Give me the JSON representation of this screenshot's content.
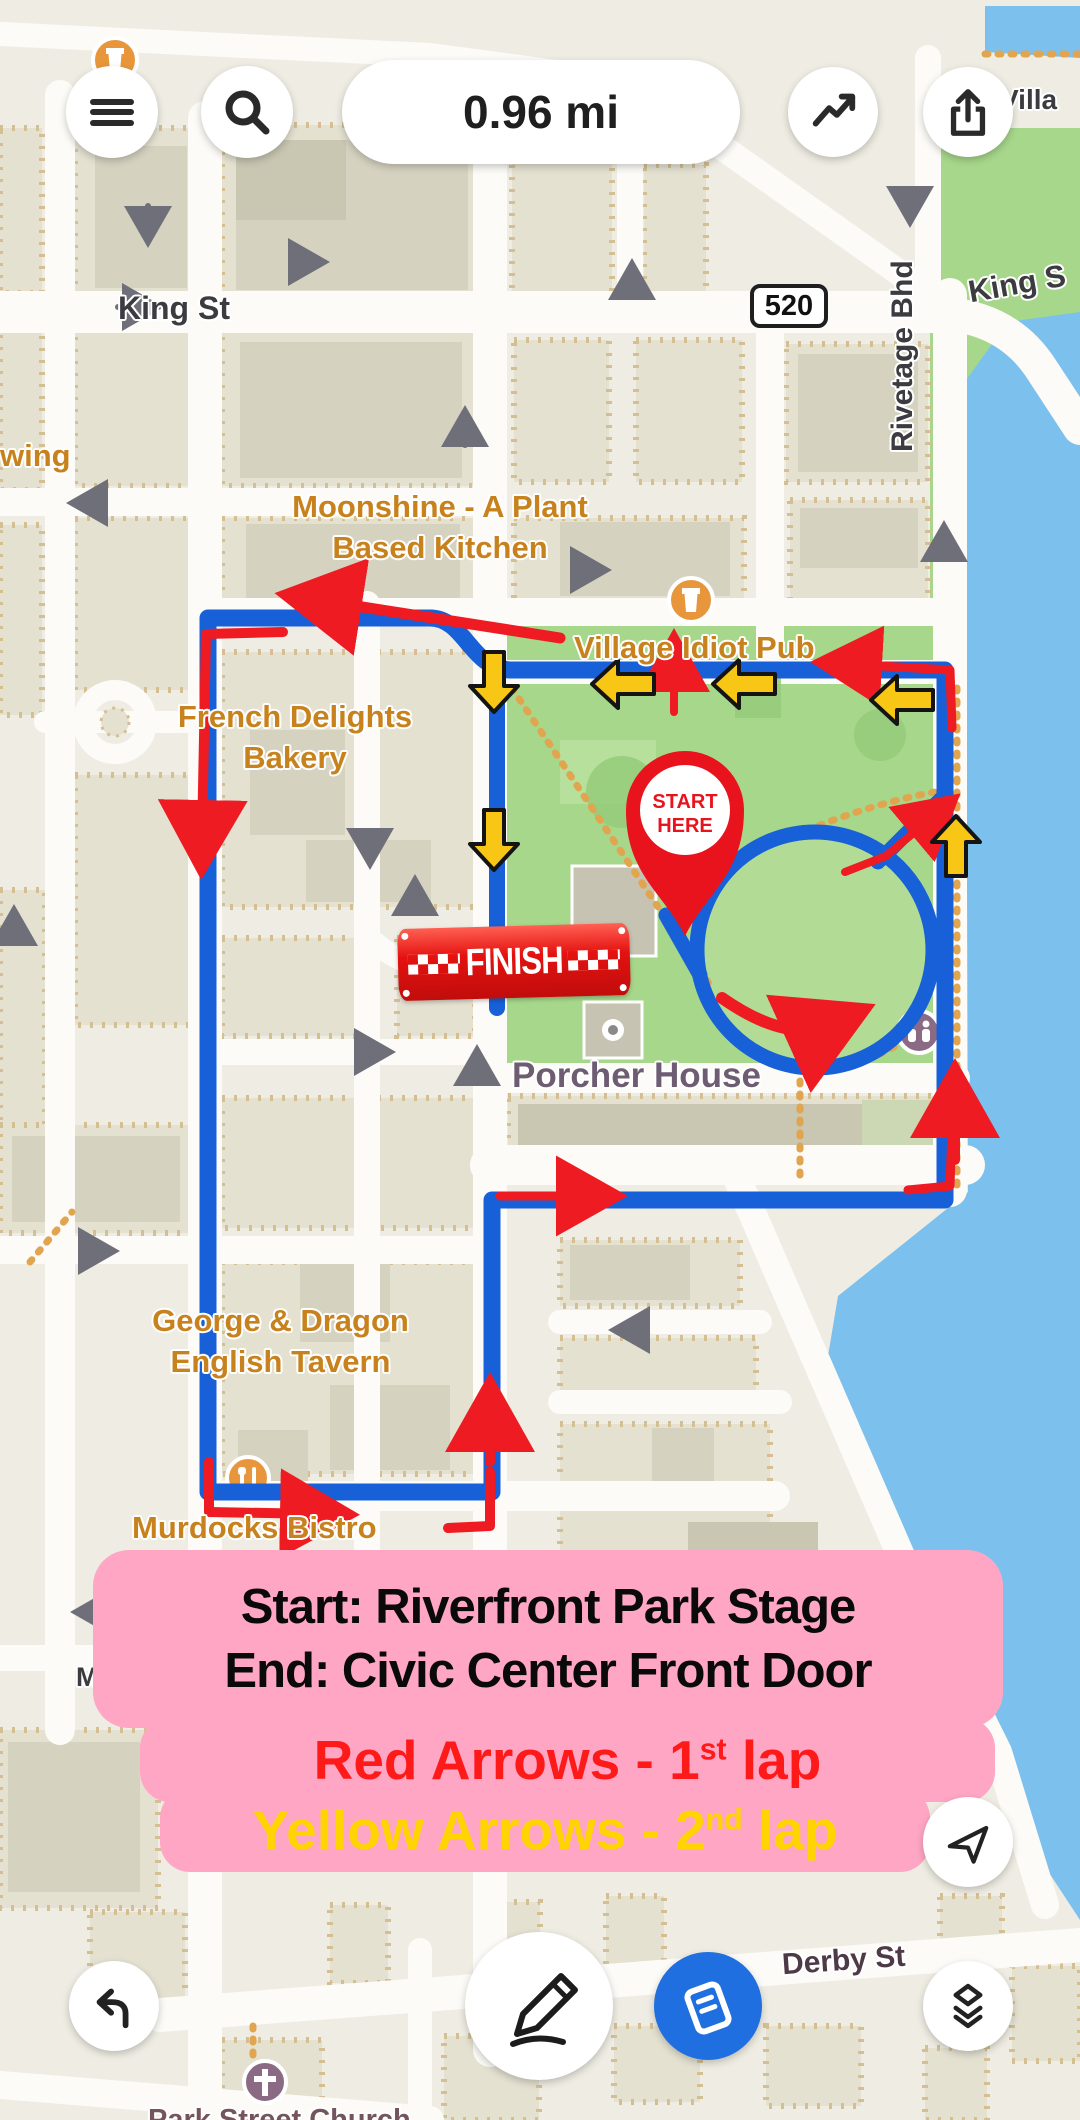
{
  "header": {
    "distance_value": "0.96 mi"
  },
  "map": {
    "streets": {
      "king_st": "King St",
      "king_s": "King S",
      "rivetage": "Rivetage Bhd",
      "derby": "Derby St",
      "villa": "Villa",
      "wing": "wing",
      "ma": "Ma",
      "in": "In",
      "route_shield": "520",
      "partial_bottom": "Park Street Church"
    },
    "pois": {
      "moonshine_1": "Moonshine - A Plant",
      "moonshine_2": "Based Kitchen",
      "french_1": "French Delights",
      "french_2": "Bakery",
      "village": "Village Idiot Pub",
      "george_1": "George & Dragon",
      "george_2": "English Tavern",
      "murdocks": "Murdocks Bistro",
      "porcher": "Porcher House"
    }
  },
  "start_marker": {
    "line1": "START",
    "line2": "HERE"
  },
  "finish_banner": {
    "label": "FINISH"
  },
  "info_box": {
    "line1": "Start: Riverfront Park Stage",
    "line2": "End: Civic Center Front Door",
    "red_prefix": "Red Arrows - 1",
    "red_sup": "st",
    "red_suffix": " lap",
    "yellow_prefix": "Yellow Arrows - 2",
    "yellow_sup": "nd",
    "yellow_suffix": " lap"
  },
  "icons": {
    "menu": "hamburger-menu",
    "search": "magnifier",
    "stats": "trending-line",
    "share": "box-up-arrow",
    "back": "undo-turn-arrow",
    "draw": "pencil",
    "route_card": "tilted-map-card",
    "layers": "stacked-layers",
    "locate": "paper-plane",
    "start_pin": "map-pin",
    "pub": "beer-glass",
    "restaurant": "fork-knife",
    "restroom": "two-figures",
    "church": "cross"
  },
  "colors": {
    "route_blue": "#1760d8",
    "arrow_red": "#ee1b22",
    "arrow_yellow": "#f8c716",
    "info_pink": "#ffa6c5",
    "label_orange": "#c8821d",
    "water": "#7cc0ee",
    "park": "#a7d78b",
    "accent_button_blue": "#1f6fe0"
  }
}
